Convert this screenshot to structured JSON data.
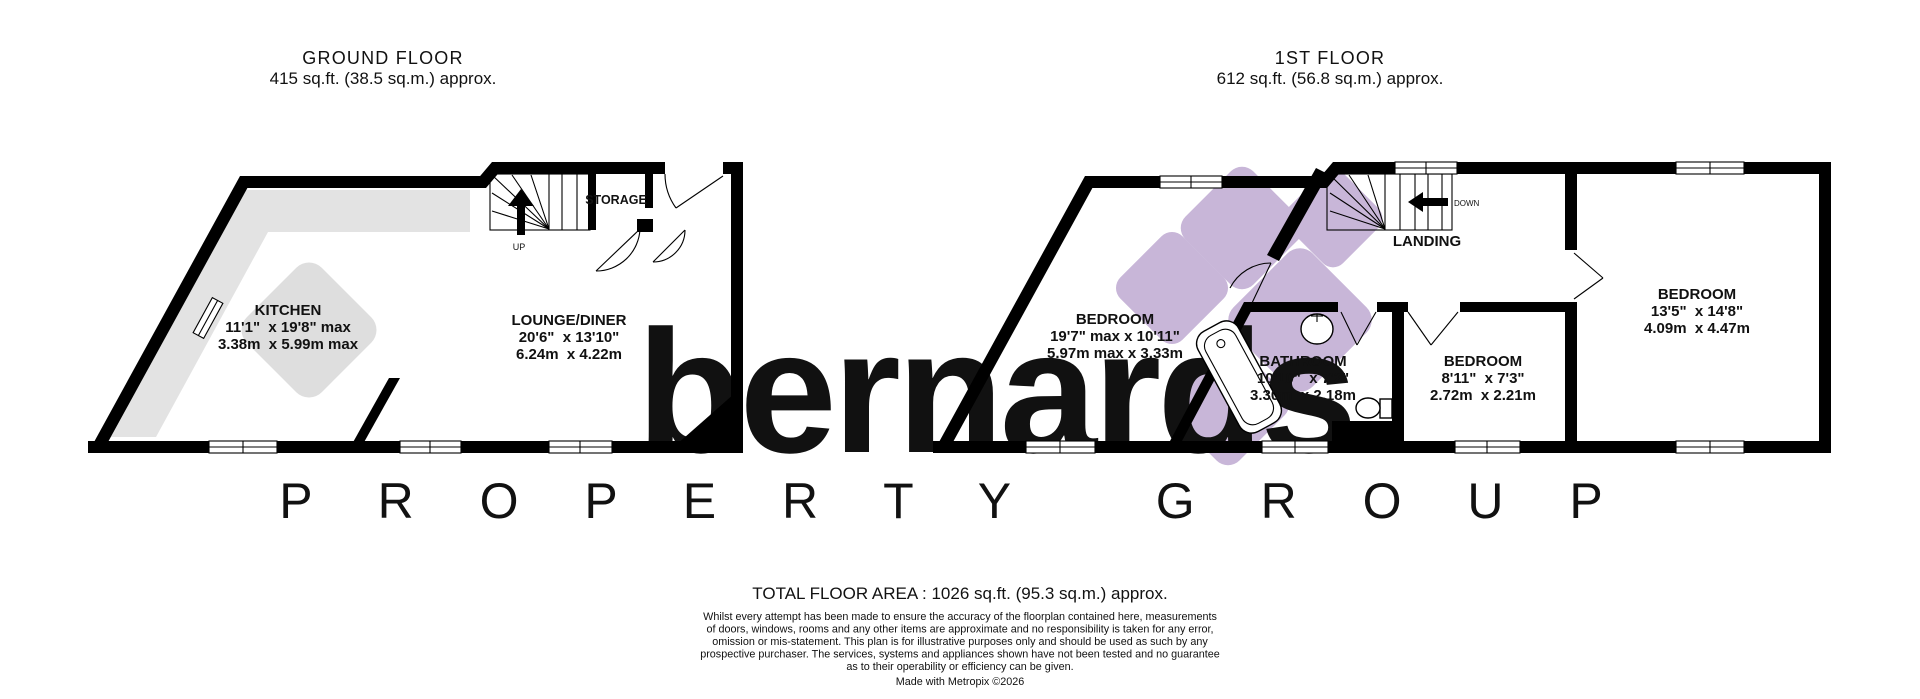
{
  "ground_floor": {
    "title": "GROUND FLOOR",
    "area": "415 sq.ft. (38.5 sq.m.) approx.",
    "kitchen": {
      "name": "KITCHEN",
      "imperial": "11'1\"  x 19'8\" max",
      "metric": "3.38m  x 5.99m max"
    },
    "lounge": {
      "name": "LOUNGE/DINER",
      "imperial": "20'6\"  x 13'10\"",
      "metric": "6.24m  x 4.22m"
    },
    "storage_label": "STORAGE",
    "up_label": "UP"
  },
  "first_floor": {
    "title": "1ST FLOOR",
    "area": "612 sq.ft. (56.8 sq.m.) approx.",
    "bedroom1": {
      "name": "BEDROOM",
      "imperial": "19'7\" max x 10'11\"",
      "metric": "5.97m max x 3.33m"
    },
    "bathroom": {
      "name": "BATHROOM",
      "imperial": "10'10\"  x 7'2\"",
      "metric": "3.30m  x 2.18m"
    },
    "bedroom2": {
      "name": "BEDROOM",
      "imperial": "8'11\"  x 7'3\"",
      "metric": "2.72m  x 2.21m"
    },
    "bedroom3": {
      "name": "BEDROOM",
      "imperial": "13'5\"  x 14'8\"",
      "metric": "4.09m  x 4.47m"
    },
    "landing_label": "LANDING",
    "down_label": "DOWN"
  },
  "watermark": {
    "brand": "bernards",
    "tagline": "P R O P E R T Y   G R O U P"
  },
  "colors": {
    "wall_black": "#000000",
    "watermark_purple": "#c8b6d8",
    "watermark_gray": "#c9c9c9",
    "kitchen_counter_gray": "#e3e3e3",
    "petal_gray": "#dedede"
  },
  "footer": {
    "total_area": "TOTAL FLOOR AREA : 1026 sq.ft. (95.3 sq.m.) approx.",
    "disclaimer_lines": [
      "Whilst every attempt has been made to ensure the accuracy of the floorplan contained here, measurements",
      "of doors, windows, rooms and any other items are approximate and no responsibility is taken for any error,",
      "omission or mis-statement. This plan is for illustrative purposes only and should be used as such by any",
      "prospective purchaser. The services, systems and appliances shown have not been tested and no guarantee",
      "as to their operability or efficiency can be given."
    ],
    "credit": "Made with Metropix ©2026"
  }
}
